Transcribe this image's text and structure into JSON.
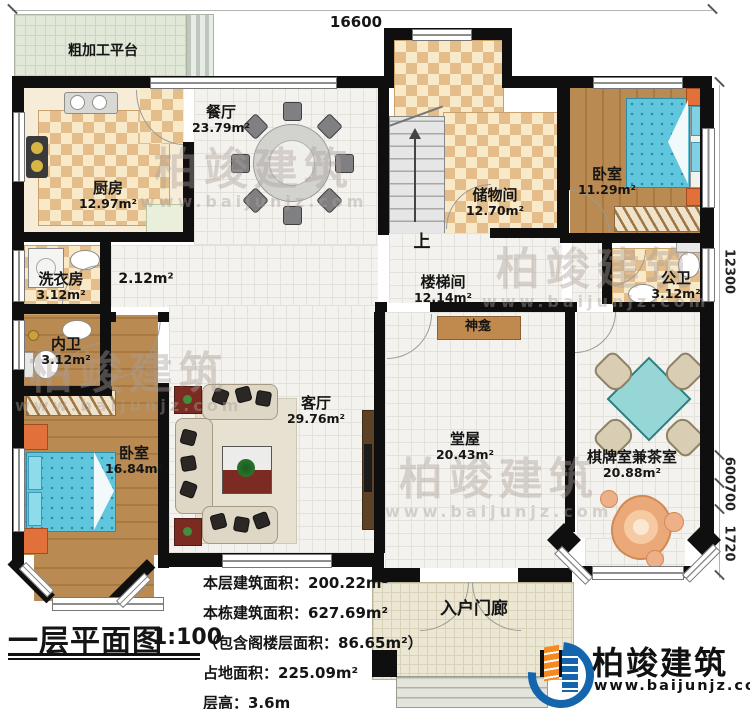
{
  "dimensions": {
    "top": "16600",
    "right_main": "12300",
    "right_segments": [
      "600",
      "700",
      "1720"
    ]
  },
  "rooms": {
    "rough_platform": {
      "name": "粗加工平台"
    },
    "kitchen": {
      "name": "厨房",
      "area": "12.97m²"
    },
    "dining": {
      "name": "餐厅",
      "area": "23.79m²"
    },
    "storage": {
      "name": "储物间",
      "area": "12.70m²"
    },
    "bedroom_top": {
      "name": "卧室",
      "area": "11.29m²"
    },
    "laundry": {
      "name": "洗衣房",
      "area": "3.12m²"
    },
    "hallway": {
      "area": "2.12m²"
    },
    "inner_bath": {
      "name": "内卫",
      "area": "3.12m²"
    },
    "bedroom_left": {
      "name": "卧室",
      "area": "16.84m²"
    },
    "living": {
      "name": "客厅",
      "area": "29.76m²"
    },
    "stairwell": {
      "name": "楼梯间",
      "area": "12.14m²"
    },
    "public_bath": {
      "name": "公卫",
      "area": "3.12m²"
    },
    "shrine": {
      "name": "神龛"
    },
    "hall": {
      "name": "堂屋",
      "area": "20.43m²"
    },
    "chess_tea": {
      "name": "棋牌室兼茶室",
      "area": "20.88m²"
    },
    "porch": {
      "name": "入户门廊"
    },
    "stairs_up": {
      "label": "上"
    }
  },
  "title_block": {
    "title": "一层平面图",
    "scale": "1:100",
    "stats": [
      "本层建筑面积：200.22m²",
      "本栋建筑面积：627.69m²",
      "（包含阁楼层面积：86.65m²）",
      "占地面积：225.09m²",
      "层高：3.6m"
    ]
  },
  "logo": {
    "brand": "柏竣建筑",
    "website": "www.baijunjz.com"
  },
  "watermark": {
    "text": "柏竣建筑",
    "sub": "www.baijunjz.com"
  }
}
